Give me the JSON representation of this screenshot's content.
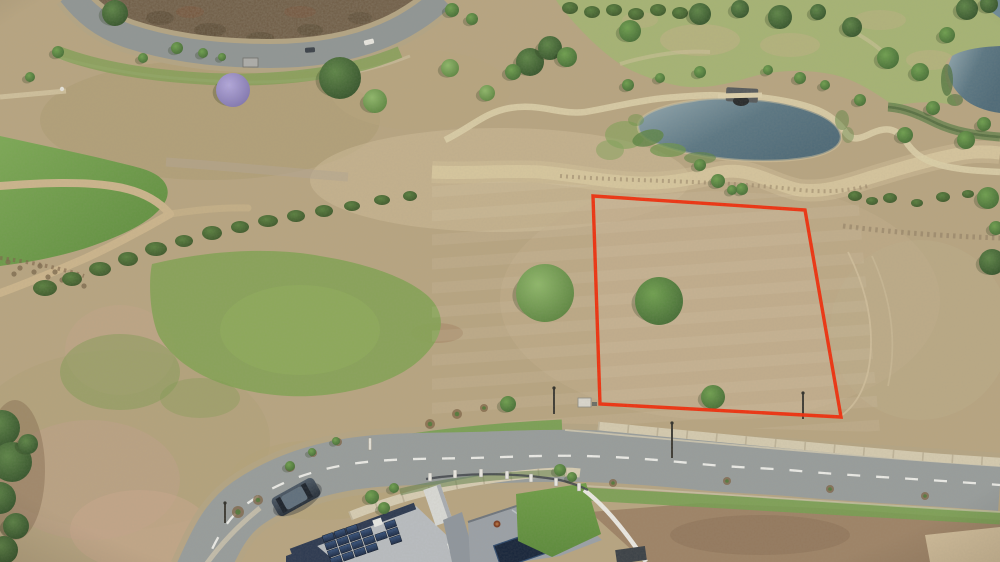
{
  "meta": {
    "type": "aerial-drone-photo",
    "subject": "vacant residential land lot outlined in red beside a curving suburban road, pond and parkland behind",
    "width": 1000,
    "height": 562
  },
  "palette": {
    "base": "#b8a581",
    "base_light": "#cbb796",
    "dry_pink": "#c5a78c",
    "scrub": "#6e5b44",
    "road": "#989d9c",
    "road_top": "#909695",
    "shoulder": "#b4a584",
    "path": "#d9c9a0",
    "grass_bright": "#6f9b48",
    "grass_mid": "#84a354",
    "golf": "#a4b573",
    "water_light": "#95aab2",
    "water_dark": "#4e6a78",
    "boundary_red": "#f12d0b",
    "roof_light": "#b9bdc1",
    "roof_dark": "#9ba1a7",
    "navy_wall": "#2b3850",
    "solar_panel": "#1b2940",
    "fence_white": "#eceae4",
    "lawn": "#679a43",
    "dirt_brown": "#9c8164",
    "cream_dirt": "#d6c3a0",
    "car_body": "#3c4854",
    "car_roof": "#5f6f7d"
  },
  "boundary": {
    "points": "593,196 805,210 841,417 600,404",
    "stroke": "#f12d0b",
    "stroke_width": 3.4
  },
  "trees": [
    [
      115,
      13,
      13,
      "dark"
    ],
    [
      58,
      52,
      6,
      "mid"
    ],
    [
      30,
      77,
      5,
      "mid"
    ],
    [
      143,
      58,
      5,
      "mid"
    ],
    [
      177,
      48,
      6,
      "mid"
    ],
    [
      203,
      53,
      5,
      "mid"
    ],
    [
      222,
      57,
      4,
      "mid"
    ],
    [
      233,
      90,
      17,
      "jac"
    ],
    [
      340,
      78,
      21,
      "dark"
    ],
    [
      375,
      101,
      12,
      "light"
    ],
    [
      452,
      10,
      7,
      "mid"
    ],
    [
      472,
      19,
      6,
      "mid"
    ],
    [
      450,
      68,
      9,
      "light"
    ],
    [
      487,
      93,
      8,
      "light"
    ],
    [
      530,
      62,
      14,
      "dark"
    ],
    [
      550,
      48,
      12,
      "dark"
    ],
    [
      567,
      57,
      10,
      "mid"
    ],
    [
      513,
      72,
      8,
      "mid"
    ],
    [
      630,
      31,
      11,
      "mid"
    ],
    [
      700,
      14,
      11,
      "dark"
    ],
    [
      740,
      9,
      9,
      "dark"
    ],
    [
      780,
      17,
      12,
      "dark"
    ],
    [
      818,
      12,
      8,
      "dark"
    ],
    [
      852,
      27,
      10,
      "dark"
    ],
    [
      888,
      58,
      11,
      "mid"
    ],
    [
      920,
      72,
      9,
      "mid"
    ],
    [
      947,
      35,
      8,
      "mid"
    ],
    [
      967,
      9,
      11,
      "dark"
    ],
    [
      989,
      4,
      9,
      "dark"
    ],
    [
      905,
      135,
      8,
      "mid"
    ],
    [
      933,
      108,
      7,
      "mid"
    ],
    [
      966,
      140,
      9,
      "mid"
    ],
    [
      984,
      124,
      7,
      "mid"
    ],
    [
      628,
      85,
      6,
      "mid"
    ],
    [
      660,
      78,
      5,
      "mid"
    ],
    [
      700,
      72,
      6,
      "mid"
    ],
    [
      768,
      70,
      5,
      "mid"
    ],
    [
      800,
      78,
      6,
      "mid"
    ],
    [
      825,
      85,
      5,
      "mid"
    ],
    [
      860,
      100,
      6,
      "mid"
    ],
    [
      700,
      165,
      6,
      "mid"
    ],
    [
      718,
      181,
      7,
      "mid"
    ],
    [
      742,
      189,
      6,
      "mid"
    ],
    [
      732,
      190,
      5,
      "mid"
    ],
    [
      988,
      198,
      11,
      "mid"
    ],
    [
      992,
      262,
      13,
      "dark"
    ],
    [
      996,
      228,
      7,
      "mid"
    ],
    [
      545,
      293,
      29,
      "light"
    ],
    [
      659,
      301,
      24,
      "mid"
    ],
    [
      713,
      397,
      12,
      "mid"
    ],
    [
      508,
      404,
      8,
      "mid"
    ],
    [
      2,
      428,
      18,
      "dark"
    ],
    [
      12,
      462,
      20,
      "dark"
    ],
    [
      0,
      498,
      16,
      "dark"
    ],
    [
      16,
      526,
      13,
      "dark"
    ],
    [
      4,
      550,
      14,
      "dark"
    ],
    [
      28,
      444,
      10,
      "dark"
    ],
    [
      372,
      497,
      7,
      "mid"
    ],
    [
      384,
      508,
      6,
      "mid"
    ],
    [
      394,
      488,
      5,
      "mid"
    ],
    [
      560,
      470,
      6,
      "mid"
    ],
    [
      572,
      477,
      5,
      "mid"
    ],
    [
      290,
      466,
      5,
      "mid"
    ],
    [
      312,
      452,
      4,
      "mid"
    ],
    [
      336,
      441,
      4,
      "mid"
    ]
  ],
  "bushes": [
    [
      45,
      288,
      12,
      8
    ],
    [
      72,
      279,
      10,
      7
    ],
    [
      100,
      269,
      11,
      7
    ],
    [
      128,
      259,
      10,
      7
    ],
    [
      156,
      249,
      11,
      7
    ],
    [
      184,
      241,
      9,
      6
    ],
    [
      212,
      233,
      10,
      7
    ],
    [
      240,
      227,
      9,
      6
    ],
    [
      268,
      221,
      10,
      6
    ],
    [
      296,
      216,
      9,
      6
    ],
    [
      324,
      211,
      9,
      6
    ],
    [
      352,
      206,
      8,
      5
    ],
    [
      382,
      200,
      8,
      5
    ],
    [
      410,
      196,
      7,
      5
    ],
    [
      855,
      196,
      7,
      5
    ],
    [
      872,
      201,
      6,
      4
    ],
    [
      890,
      198,
      7,
      5
    ],
    [
      917,
      203,
      6,
      4
    ],
    [
      943,
      197,
      7,
      5
    ],
    [
      968,
      194,
      6,
      4
    ],
    [
      986,
      197,
      5,
      4
    ],
    [
      570,
      8,
      8,
      6
    ],
    [
      592,
      12,
      8,
      6
    ],
    [
      614,
      10,
      8,
      6
    ],
    [
      636,
      14,
      8,
      6
    ],
    [
      658,
      10,
      8,
      6
    ],
    [
      680,
      13,
      8,
      6
    ],
    [
      698,
      9,
      7,
      5
    ]
  ],
  "rocks": [
    [
      8,
      262
    ],
    [
      20,
      268
    ],
    [
      34,
      272
    ],
    [
      48,
      277
    ],
    [
      62,
      280
    ],
    [
      14,
      274
    ],
    [
      40,
      266
    ],
    [
      55,
      272
    ],
    [
      70,
      282
    ],
    [
      84,
      286
    ]
  ],
  "mulch_rings": [
    [
      238,
      512,
      6
    ],
    [
      258,
      500,
      5
    ],
    [
      290,
      467,
      5
    ],
    [
      313,
      453,
      4
    ],
    [
      338,
      442,
      4
    ],
    [
      430,
      424,
      5
    ],
    [
      457,
      414,
      5
    ],
    [
      484,
      408,
      4
    ],
    [
      613,
      483,
      4
    ],
    [
      727,
      481,
      4
    ],
    [
      830,
      489,
      4
    ],
    [
      925,
      496,
      4
    ]
  ],
  "fence_posts": [
    [
      430,
      477
    ],
    [
      455,
      474
    ],
    [
      481,
      473
    ],
    [
      507,
      475
    ],
    [
      531,
      478
    ],
    [
      556,
      482
    ],
    [
      579,
      487
    ]
  ],
  "poles": [
    [
      554,
      388,
      26
    ],
    [
      672,
      423,
      35
    ],
    [
      803,
      393,
      26
    ],
    [
      225,
      503,
      20
    ]
  ],
  "bollards": [
    [
      370,
      444
    ]
  ],
  "top_road_vehicles": [
    [
      310,
      50,
      -4,
      "#3a4149"
    ],
    [
      369,
      42,
      -14,
      "#e9e7e1"
    ]
  ],
  "solar": {
    "origin": [
      322,
      536
    ],
    "u": [
      11.9,
      -4.1
    ],
    "v": [
      2.6,
      7.6
    ],
    "panel_u": [
      10.5,
      -3.6
    ],
    "panel_v": [
      2.2,
      6.5
    ],
    "cells": [
      [
        0,
        0
      ],
      [
        1,
        0
      ],
      [
        2,
        0
      ],
      [
        0,
        1
      ],
      [
        1,
        1
      ],
      [
        2,
        1
      ],
      [
        3,
        1
      ],
      [
        5,
        1
      ],
      [
        0,
        2
      ],
      [
        1,
        2
      ],
      [
        2,
        2
      ],
      [
        3,
        2
      ],
      [
        4,
        2
      ],
      [
        5,
        2
      ],
      [
        0,
        3
      ],
      [
        1,
        3
      ],
      [
        2,
        3
      ],
      [
        3,
        3
      ],
      [
        5,
        3
      ]
    ]
  }
}
